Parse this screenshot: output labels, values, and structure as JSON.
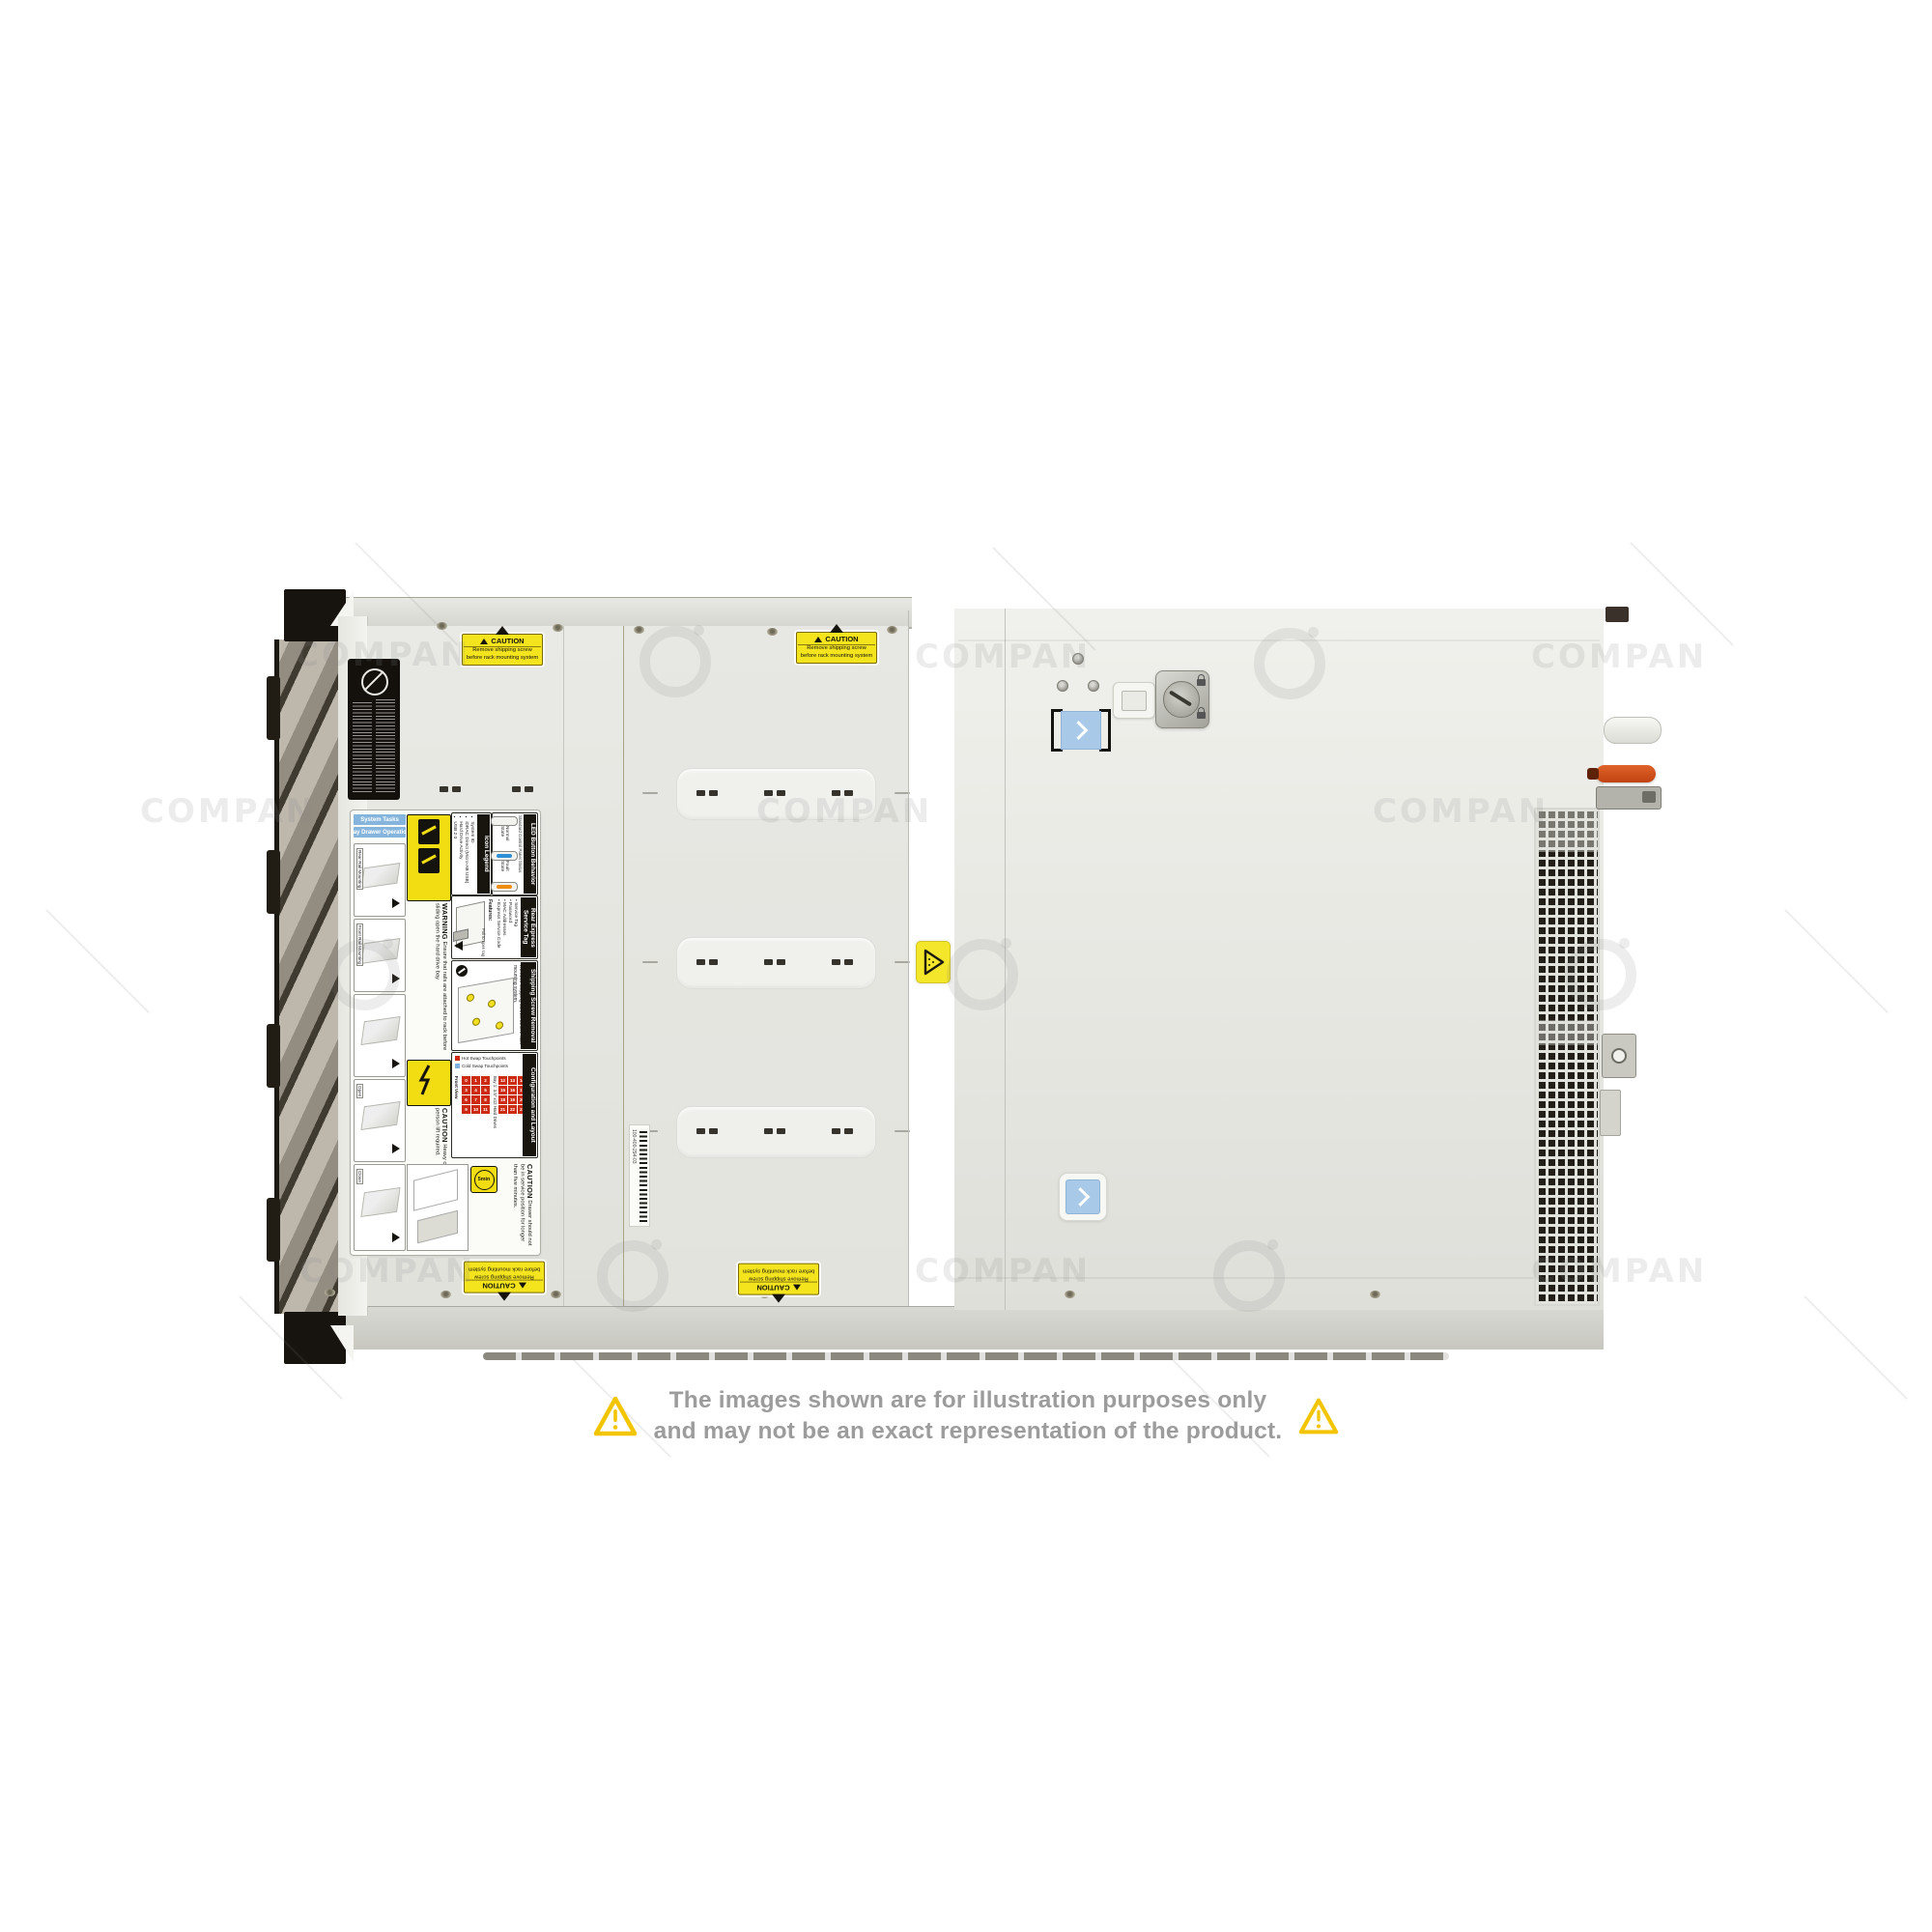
{
  "watermark": {
    "text": "COMPAN"
  },
  "disclaimer": {
    "line1": "The images shown are for illustration purposes only",
    "line2": "and may not be an exact representation of the product."
  },
  "caution_label": {
    "title": "CAUTION",
    "line1": "Remove shipping screw",
    "line2": "before rack mounting system"
  },
  "barcode_label": {
    "text": "100-400-294-03"
  },
  "service_label": {
    "system_tasks": "System Tasks",
    "bay_drawer_operation": "Bay Drawer Operation",
    "sketch_captions": [
      "Rear Rail Mounting",
      "Front Rail Mounting",
      "Open",
      "Close"
    ],
    "warning_title": "WARNING",
    "warning_text": "Ensure that rails are attached to rack before sliding open the hard drive bay",
    "caution_heavy_title": "CAUTION",
    "caution_heavy_text": "Heavy chassis. Two person lift required.",
    "five_min": "5min",
    "caution_drawer_title": "CAUTION",
    "caution_drawer_text": "Drawer should not be in service position for longer than five minutes.",
    "icon_legend_title": "Icon Legend",
    "icon_legend_items": [
      "System ID",
      "iDRAC Direct (Micro-AB USB)",
      "Hard Drive Activity",
      "USB 2.0"
    ],
    "led_title": "LED Button Behavior",
    "led_subtitle": "Standard Control Panel Status",
    "normal_state": "Normal State",
    "fault_state": "Fault State",
    "rear_tag_title": "Rear Express Service Tag",
    "features_title": "Features:",
    "features": [
      "Service Tag",
      "Password",
      "MAC Addresses",
      "Express Service Code"
    ],
    "pull_tag": "Pull to open tag",
    "shipping_title": "Shipping Screw Removal",
    "shipping_text": "Remove shipping screws before rack mounting system.",
    "config_title": "Configuration and Layout",
    "front_view": "Front View",
    "hot_swap": "Hot Swap Touchpoints",
    "cold_swap": "Cold Swap Touchpoints",
    "bay1_label": "Bay 1: 3.5\" x12 Hard Drives",
    "bay2_label": "Bay 2: 3.5\" x12 Hard Drives",
    "bay1_numbers": [
      "0",
      "1",
      "2",
      "3",
      "4",
      "5",
      "6",
      "7",
      "8",
      "9",
      "10",
      "11"
    ],
    "bay2_numbers": [
      "12",
      "13",
      "14",
      "15",
      "16",
      "17",
      "18",
      "19",
      "20",
      "21",
      "22",
      "23"
    ]
  },
  "colors": {
    "accent_blue": "#a9c9e9",
    "caution_yellow": "#f2dc12",
    "hot_swap_red": "#cd2a12",
    "lever_orange": "#d9531e",
    "warning_triangle": "#f5c400"
  }
}
